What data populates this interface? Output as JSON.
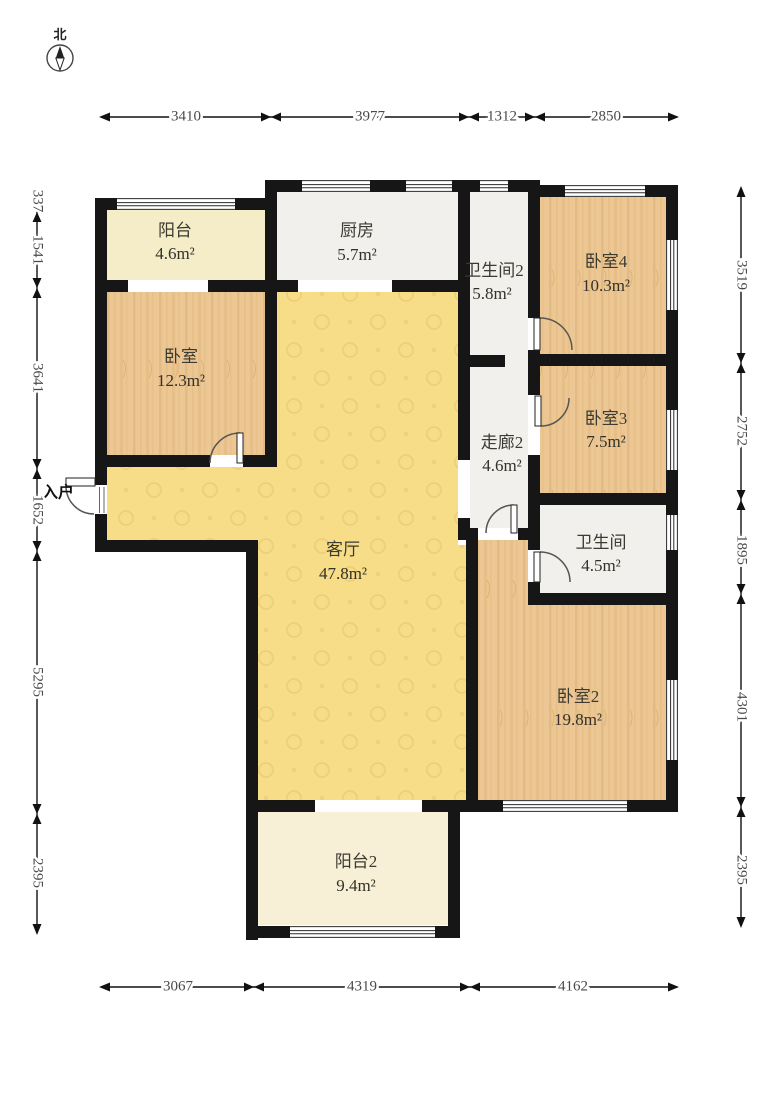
{
  "compass": {
    "label": "北"
  },
  "entrance": {
    "label": "入户"
  },
  "rooms": {
    "balcony": {
      "name": "阳台",
      "area": "4.6m²"
    },
    "kitchen": {
      "name": "厨房",
      "area": "5.7m²"
    },
    "bath2": {
      "name": "卫生间2",
      "area": "5.8m²"
    },
    "bed4": {
      "name": "卧室4",
      "area": "10.3m²"
    },
    "bedroom": {
      "name": "卧室",
      "area": "12.3m²"
    },
    "corridor2": {
      "name": "走廊2",
      "area": "4.6m²"
    },
    "bed3": {
      "name": "卧室3",
      "area": "7.5m²"
    },
    "living": {
      "name": "客厅",
      "area": "47.8m²"
    },
    "bath": {
      "name": "卫生间",
      "area": "4.5m²"
    },
    "bed2": {
      "name": "卧室2",
      "area": "19.8m²"
    },
    "balcony2": {
      "name": "阳台2",
      "area": "9.4m²"
    }
  },
  "dimensions": {
    "top": [
      "3410",
      "3977",
      "1312",
      "2850"
    ],
    "bottom": [
      "3067",
      "4319",
      "4162"
    ],
    "left": [
      "337",
      "1541",
      "3641",
      "1652",
      "5295",
      "2395"
    ],
    "right": [
      "3519",
      "2752",
      "1895",
      "4301",
      "2395"
    ]
  },
  "colors": {
    "wall": "#161616",
    "living_floor": "#f7dd88",
    "wood_floor": "#ecc793",
    "balcony_floor": "#f5ecc8",
    "tile_floor": "#f1f0ed"
  }
}
